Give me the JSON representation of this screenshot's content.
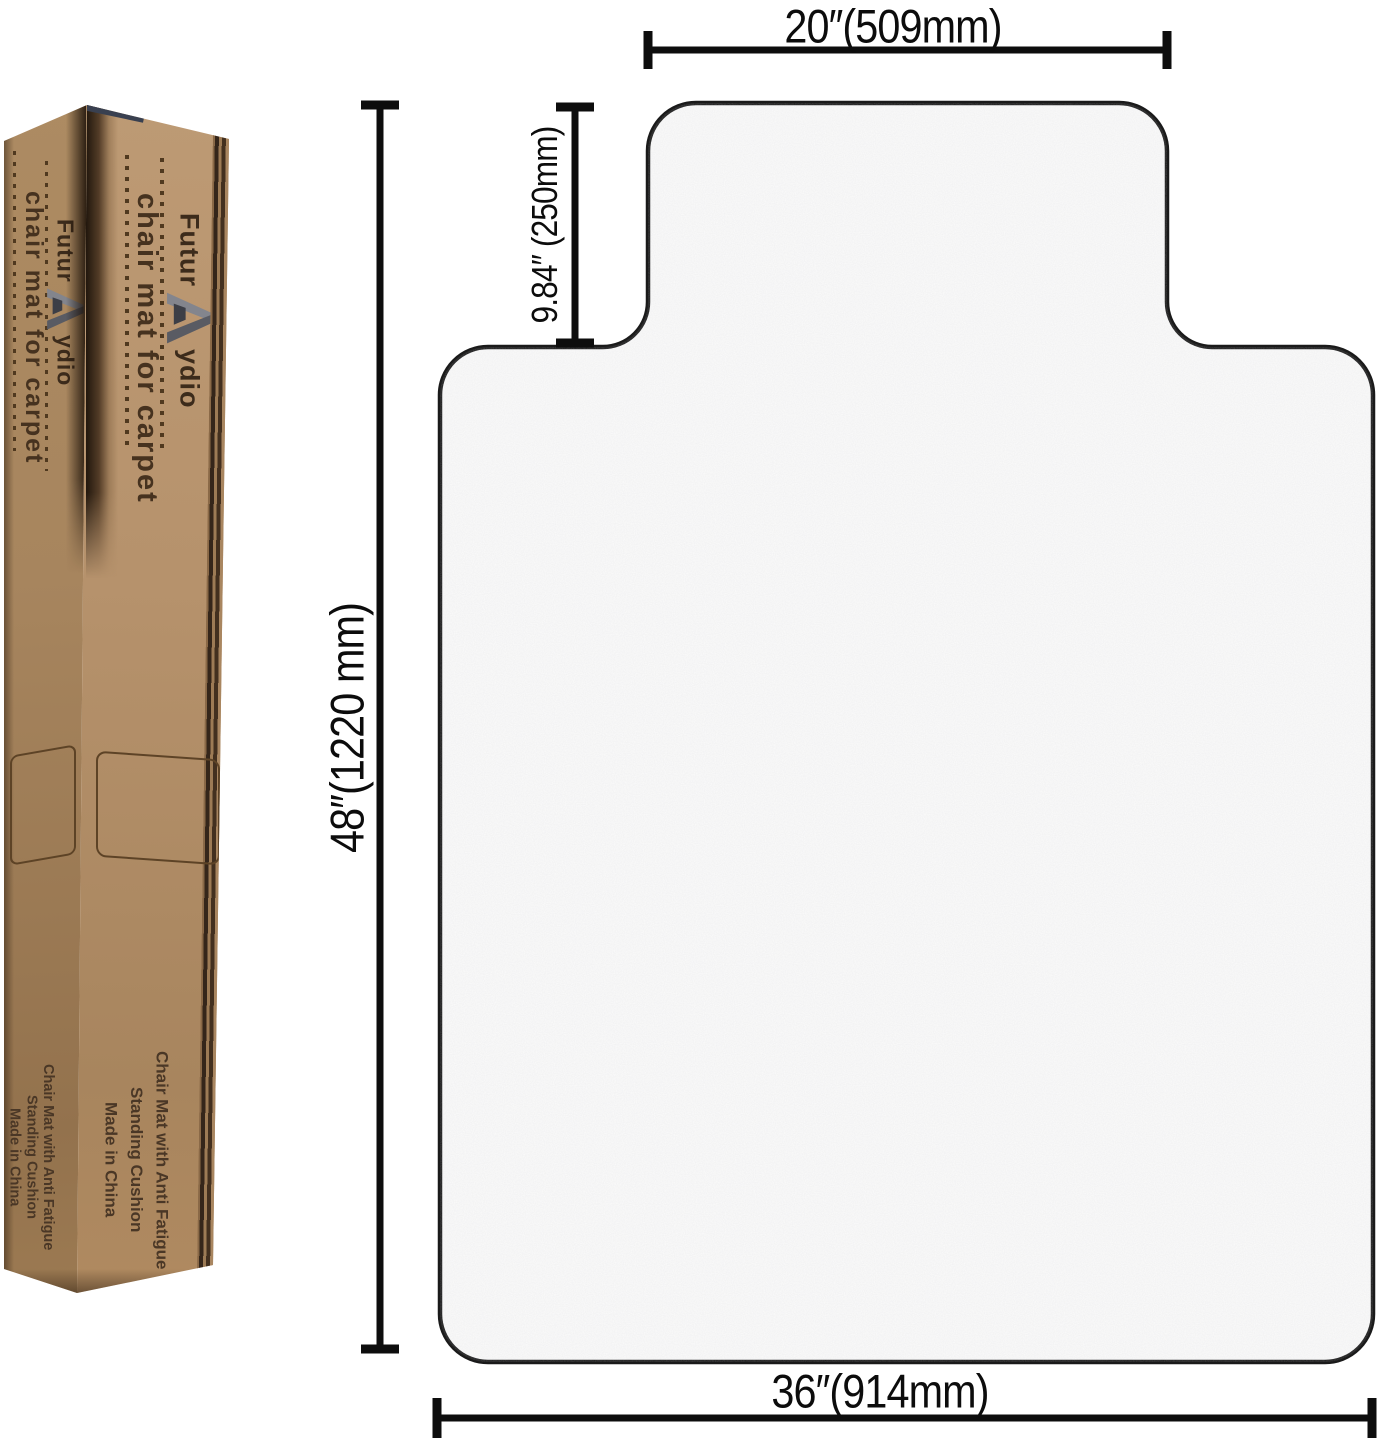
{
  "product_diagram": {
    "dimensions": {
      "lip_width": "20″(509mm)",
      "lip_depth": "9.84″ (250mm)",
      "length": "48″(1220 mm)",
      "width": "36″(914mm)"
    }
  },
  "box": {
    "brand_prefix": "Futur",
    "brand_suffix": "ydio",
    "logo_icon": "stylized-a-chevron-logo",
    "product_text": "chair mat for carpet",
    "label_lines": [
      "Chair Mat with Anti Fatigue",
      "Standing Cushion",
      "Made in China"
    ]
  },
  "colors": {
    "background": "#ffffff",
    "mat_fill": "#fbfbfb",
    "mat_outline": "#1a1a1a",
    "dimension_ink": "#0d0d0d",
    "kraft_light": "#b6926c",
    "kraft_dark": "#a5835c",
    "box_print": "#46321f"
  }
}
